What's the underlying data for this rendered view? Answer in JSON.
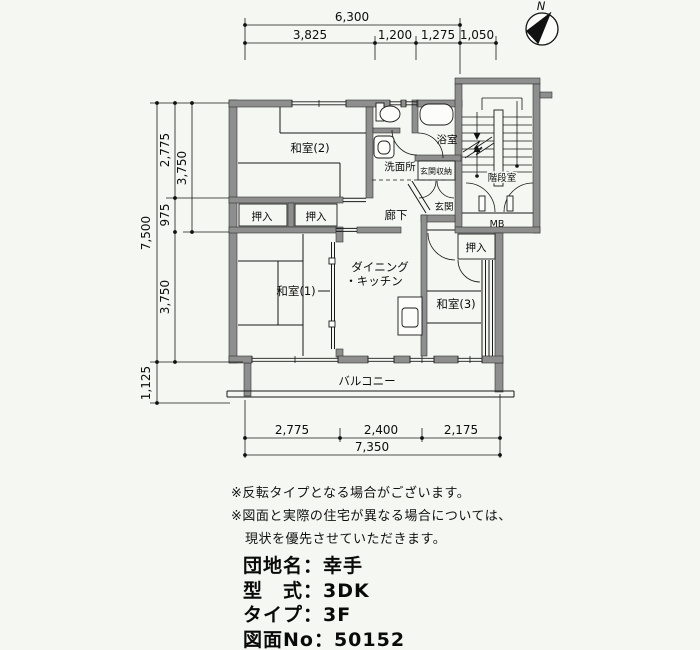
{
  "compass": {
    "north_label": "N"
  },
  "dimensions": {
    "top": {
      "total": "6,300",
      "segments": [
        "3,825",
        "1,200",
        "1,275",
        "1,050"
      ]
    },
    "left": {
      "total": "7,500",
      "segments": [
        "2,775",
        "975",
        "3,750"
      ],
      "upper_span": "3,750",
      "balcony_depth": "1,125"
    },
    "bottom": {
      "total": "7,350",
      "segments": [
        "2,775",
        "2,400",
        "2,175"
      ]
    }
  },
  "rooms": {
    "washitsu2": "和室(2)",
    "washitsu1": "和室(1)",
    "washitsu3": "和室(3)",
    "dining_line1": "ダイニング",
    "dining_line2": "・キッチン",
    "senmenjo": "洗面所",
    "yokushitsu": "浴室",
    "genkan_shunou": "玄関収納",
    "genkan": "玄関",
    "kaidanshitsu": "階段室",
    "rouka": "廊下",
    "mb": "MB",
    "oshiire": "押入",
    "balcony": "バルコニー"
  },
  "notes": [
    "※反転タイプとなる場合がございます。",
    "※図面と実際の住宅が異なる場合については、",
    "現状を優先させていただきます。"
  ],
  "info": {
    "lines": [
      "団地名：幸手",
      "型　式：3DK",
      "タイプ：3F",
      "図面No：50152"
    ]
  }
}
